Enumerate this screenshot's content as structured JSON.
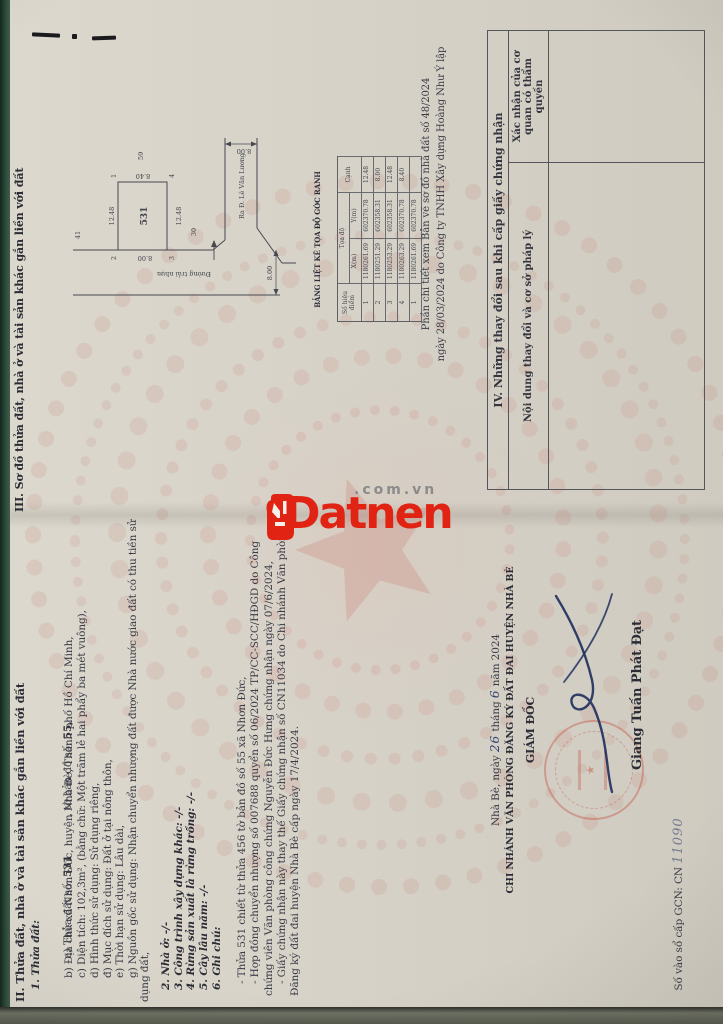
{
  "doc": {
    "section2": {
      "heading": "II. Thửa đất, nhà ở và tài sản khác gắn liền với đất",
      "sub1": "1. Thửa đất:",
      "line_a": {
        "label": "a) Thửa đất số: ",
        "value": "531",
        "mid": "            , tờ bản đồ số: ",
        "value2": "55,"
      },
      "lines": [
        "b) Địa chỉ: xã Nhơn Đức, huyện Nhà Bè, Thành phố Hồ Chí Minh,",
        "c) Diện tích: 102,3m², (bằng chữ: Một trăm lẻ hai phẩy ba mét vuông),",
        "d) Hình thức sử dụng: Sử dụng riêng,",
        "đ) Mục đích sử dụng: Đất ở tại nông thôn,",
        "e) Thời hạn sử dụng: Lâu dài,",
        "g) Nguồn gốc sử dụng: Nhận chuyển nhượng đất được Nhà nước giao đất có thu tiền sử",
        "dụng đất,"
      ],
      "items": [
        "2. Nhà ở: -/-",
        "3. Công trình xây dựng khác: -/-",
        "4. Rừng sản xuất là rừng trồng: -/-",
        "5. Cây lâu năm: -/-",
        "6. Ghi chú:"
      ],
      "notes": [
        "- Thửa 531 chiết từ thửa 456 tờ bản đồ số 55 xã Nhơn Đức,",
        "- Hợp đồng chuyển nhượng số 007688 quyển số 06/2024 TP/CC-SCC/HĐGD do Công",
        "chứng viên Văn phòng công chứng Nguyễn Đức Hưng chứng nhận ngày 07/6/2024,",
        "- Giấy chứng nhận này thay thế Giấy chứng nhận số CN11034 do Chi nhánh Văn phòng",
        "Đăng ký đất đai huyện Nhà Bè cấp ngày 17/4/2024."
      ]
    },
    "sign": {
      "date_prefix": "Nhà Bè, ngày",
      "day": "26",
      "thang": "tháng",
      "month": "6",
      "year_suffix": "năm 2024",
      "org": "CHI NHÁNH VĂN PHÒNG ĐĂNG KÝ ĐẤT ĐAI HUYỆN NHÀ BÈ",
      "title": "GIÁM ĐỐC",
      "signer": "Giang Tuấn Phát Đạt"
    },
    "gcn": {
      "label": "Số vào sổ cấp GCN: CN ",
      "number": "11090"
    },
    "section3": {
      "heading": "III. Sơ đồ thửa đất, nhà ở và tài sản khác gắn liền với đất",
      "note_line1": "Phần chi tiết xem Bản vẽ sơ đồ nhà đất số 48/2024",
      "note_line2": "ngày 28/03/2024 do Công ty TNHH Xây dựng Hoàng Như Ý lập",
      "diagram": {
        "plot": "531",
        "corner_1": "1",
        "corner_2": "2",
        "corner_3": "3",
        "corner_4": "4",
        "dim_top": "12.48",
        "dim_bottom": "12.48",
        "dim_right": "8.40",
        "dim_left": "8.00",
        "neighbor_top": "41",
        "neighbor_right": "59",
        "neighbor_bottom": "30",
        "road_left": "Đường trải nhựa",
        "road_right": "Ra Đ. Lê Văn Lương",
        "road_width_1": "8.00",
        "road_width_2": "8.00"
      },
      "coord_table": {
        "title": "BẢNG LIỆT KÊ TỌA ĐỘ GÓC RANH",
        "col_point": "Số hiệu điểm",
        "col_coords": "Tọa độ",
        "col_x": "X(m)",
        "col_y": "Y(m)",
        "col_edge": "Cạnh",
        "rows": [
          {
            "pt": "1",
            "x": "1180261.69",
            "y": "602370.78",
            "edge": "12.48"
          },
          {
            "pt": "2",
            "x": "1180251.29",
            "y": "602358.31",
            "edge": "8.00"
          },
          {
            "pt": "3",
            "x": "1180253.29",
            "y": "602358.31",
            "edge": "12.48"
          },
          {
            "pt": "4",
            "x": "1180263.29",
            "y": "602370.78",
            "edge": "8.40"
          },
          {
            "pt": "1",
            "x": "1180261.69",
            "y": "602370.78",
            "edge": ""
          }
        ]
      }
    },
    "section4": {
      "heading": "IV. Những thay đổi sau khi cấp giấy chứng nhận",
      "col1": "Nội dung thay đổi và cơ sở pháp lý",
      "col2": "Xác nhận của cơ quan có thẩm quyền"
    },
    "watermark": {
      "brand": "Datnen",
      "suffix": ".com.vn",
      "brand_color": "#e02313"
    }
  }
}
